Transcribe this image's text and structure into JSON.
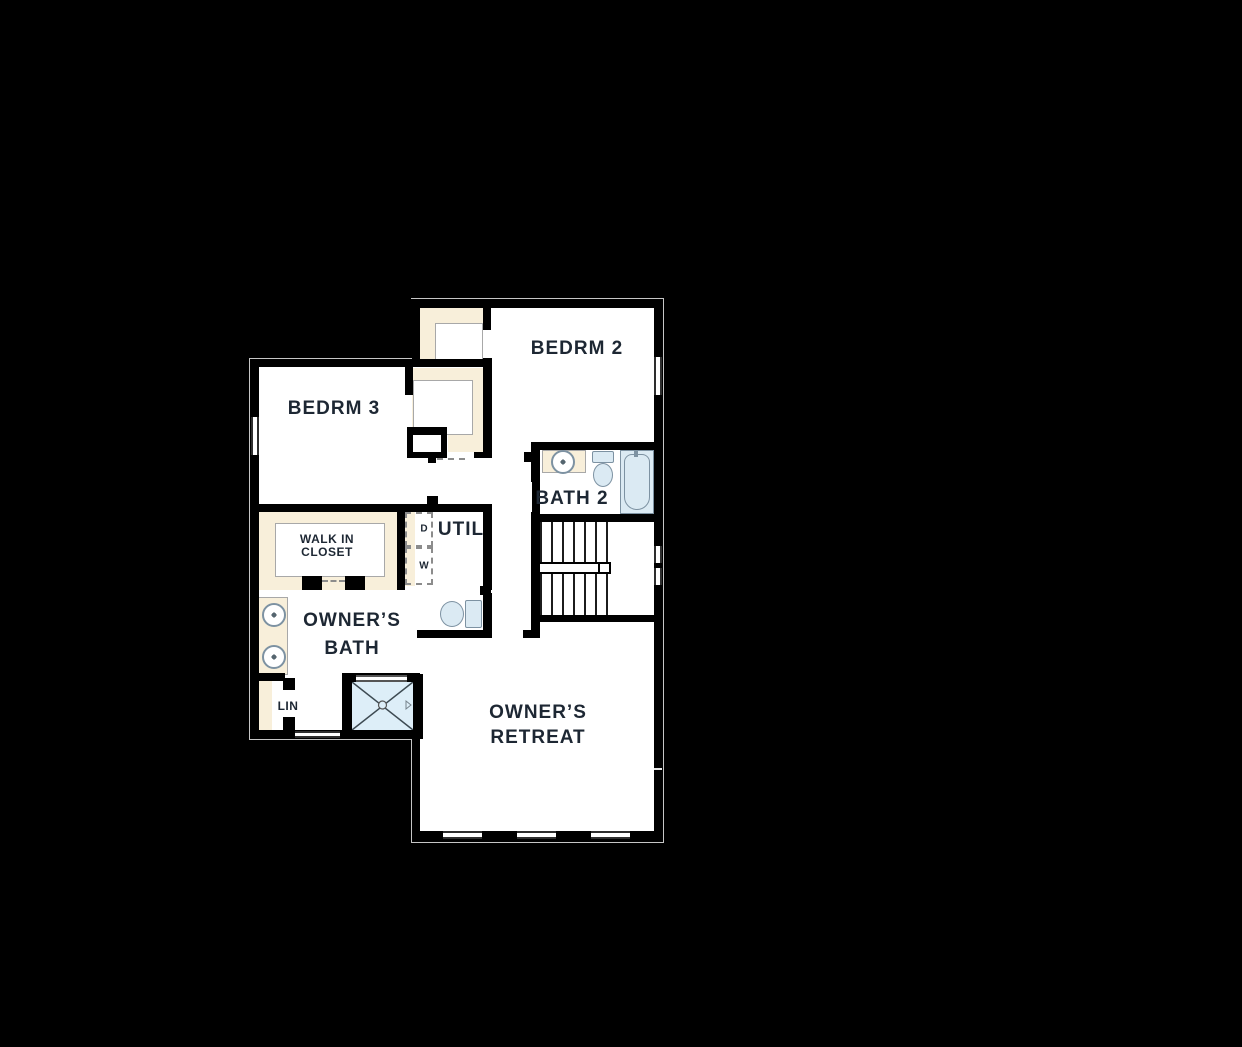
{
  "title": "Second floor residential floor plan",
  "palette": {
    "background": "#000000",
    "wall": "#000000",
    "floor": "#ffffff",
    "closet_fill": "#f8efda",
    "fixture_fill": "#dbeaf3",
    "fixture_line": "#7d92a2",
    "label_color": "#1d2733",
    "exterior_outline": "#c6c6c6"
  },
  "rooms": {
    "bedrm2": {
      "label": "BEDRM 2"
    },
    "bedrm3": {
      "label": "BEDRM 3"
    },
    "bath2": {
      "label": "BATH 2"
    },
    "walk_in_closet": {
      "line1": "WALK IN",
      "line2": "CLOSET"
    },
    "util": {
      "label": "UTIL"
    },
    "owners_bath": {
      "line1": "OWNER’S",
      "line2": "BATH"
    },
    "lin": {
      "label": "LIN"
    },
    "owners_retreat": {
      "line1": "OWNER’S",
      "line2": "RETREAT"
    },
    "dryer": {
      "label": "D"
    },
    "washer": {
      "label": "W"
    }
  },
  "fixtures": {
    "bath2": [
      "sink",
      "toilet",
      "tub"
    ],
    "owners_bath": [
      "double-sink",
      "toilet",
      "shower"
    ],
    "circulation": [
      "switchback-staircase"
    ],
    "windows": 7
  }
}
